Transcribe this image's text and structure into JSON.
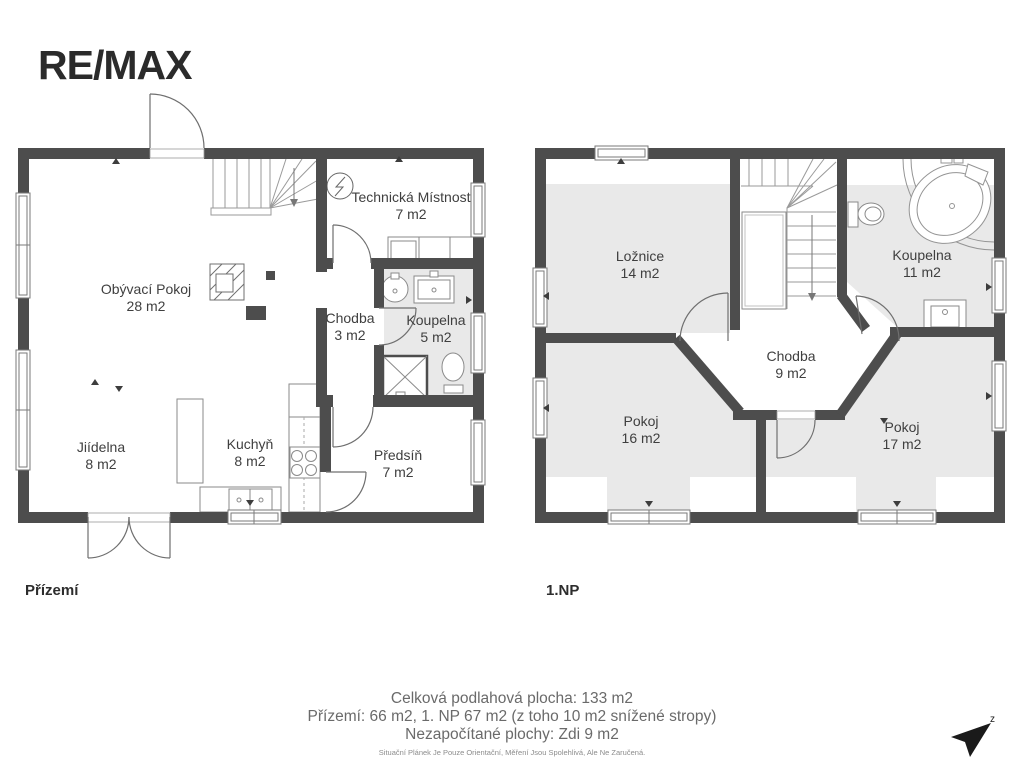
{
  "logo": {
    "text": "RE/MAX"
  },
  "plans": [
    {
      "label": "Přízemí",
      "rooms": [
        {
          "name": "Obývací Pokoj",
          "area": "28 m2"
        },
        {
          "name": "Technická Místnost",
          "area": "7 m2"
        },
        {
          "name": "Chodba",
          "area": "3 m2"
        },
        {
          "name": "Koupelna",
          "area": "5 m2"
        },
        {
          "name": "Jiídelna",
          "area": "8 m2"
        },
        {
          "name": "Kuchyň",
          "area": "8 m2"
        },
        {
          "name": "Předsíň",
          "area": "7 m2"
        }
      ]
    },
    {
      "label": "1.NP",
      "rooms": [
        {
          "name": "Ložnice",
          "area": "14 m2"
        },
        {
          "name": "Koupelna",
          "area": "11 m2"
        },
        {
          "name": "Chodba",
          "area": "9 m2"
        },
        {
          "name": "Pokoj",
          "area": "16 m2"
        },
        {
          "name": "Pokoj",
          "area": "17 m2"
        }
      ]
    }
  ],
  "summary": {
    "total": "Celková podlahová plocha: 133 m2",
    "floors": "Přízemí: 66 m2, 1. NP 67 m2 (z toho 10 m2 snížené stropy)",
    "excluded": "Nezapočítané plochy: Zdi 9 m2",
    "disclaimer": "Situační Plánek Je Pouze Orientační, Měření Jsou Spolehlivá, Ale Ne Zaručená."
  },
  "compass": {
    "label": "z"
  },
  "colors": {
    "wall": "#4d4d4d",
    "room_shade": "#e9e9e9",
    "fixture_line": "#8a8a8a",
    "label_text": "#3f3f3f",
    "summary_text": "#6a6a6a"
  }
}
